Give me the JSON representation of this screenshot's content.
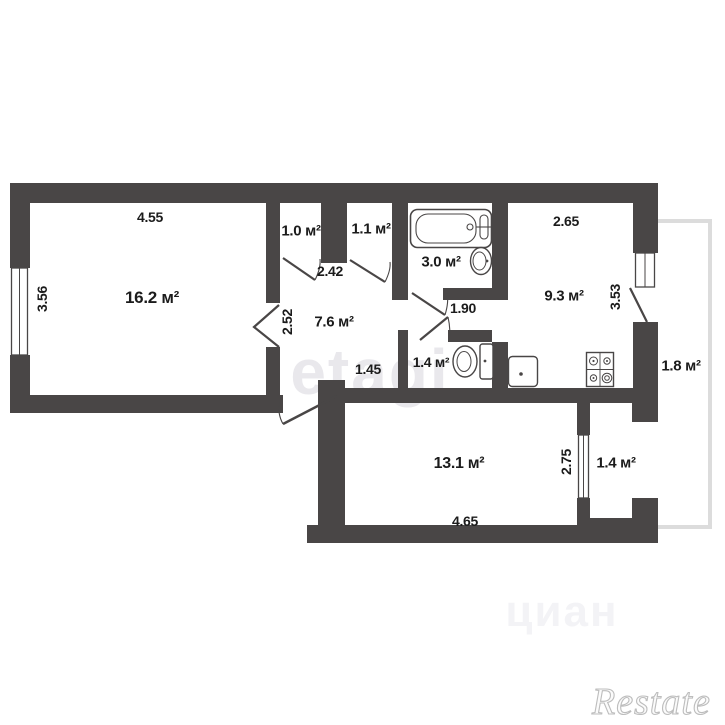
{
  "plan": {
    "title": "apartment-floor-plan",
    "rooms": [
      {
        "id": "living-room",
        "label": "16.2 м²"
      },
      {
        "id": "closet-left",
        "label": "1.0 м²"
      },
      {
        "id": "closet-right",
        "label": "1.1 м²"
      },
      {
        "id": "bathroom",
        "label": "3.0 м²"
      },
      {
        "id": "hall",
        "label": "7.6 м²"
      },
      {
        "id": "kitchen",
        "label": "9.3 м²"
      },
      {
        "id": "wc",
        "label": "1.4 м²"
      },
      {
        "id": "bedroom",
        "label": "13.1 м²"
      },
      {
        "id": "balcony-right",
        "label": "1.8 м²"
      },
      {
        "id": "balcony-bottom",
        "label": "1.4 м²"
      }
    ],
    "dimensions": [
      {
        "id": "living-width",
        "label": "4.55"
      },
      {
        "id": "living-height",
        "label": "3.56"
      },
      {
        "id": "hall-width",
        "label": "2.42"
      },
      {
        "id": "hall-height",
        "label": "2.52"
      },
      {
        "id": "hall-bottom",
        "label": "1.45"
      },
      {
        "id": "corridor-width",
        "label": "1.90"
      },
      {
        "id": "kitchen-width",
        "label": "2.65"
      },
      {
        "id": "kitchen-height",
        "label": "3.53"
      },
      {
        "id": "bedroom-height",
        "label": "2.75"
      },
      {
        "id": "bedroom-width",
        "label": "4.65"
      }
    ],
    "fixtures": [
      "bathtub",
      "wash-basin",
      "toilet",
      "kitchen-sink",
      "stove"
    ],
    "watermarks": {
      "center": "etagi",
      "bottom": "циан",
      "logo": "Restate"
    },
    "colors": {
      "wall": "#494646",
      "balcony_line": "#dcdcdc",
      "text": "#1b1b1b",
      "watermark": "#e9e8ec",
      "background": "#ffffff"
    }
  }
}
